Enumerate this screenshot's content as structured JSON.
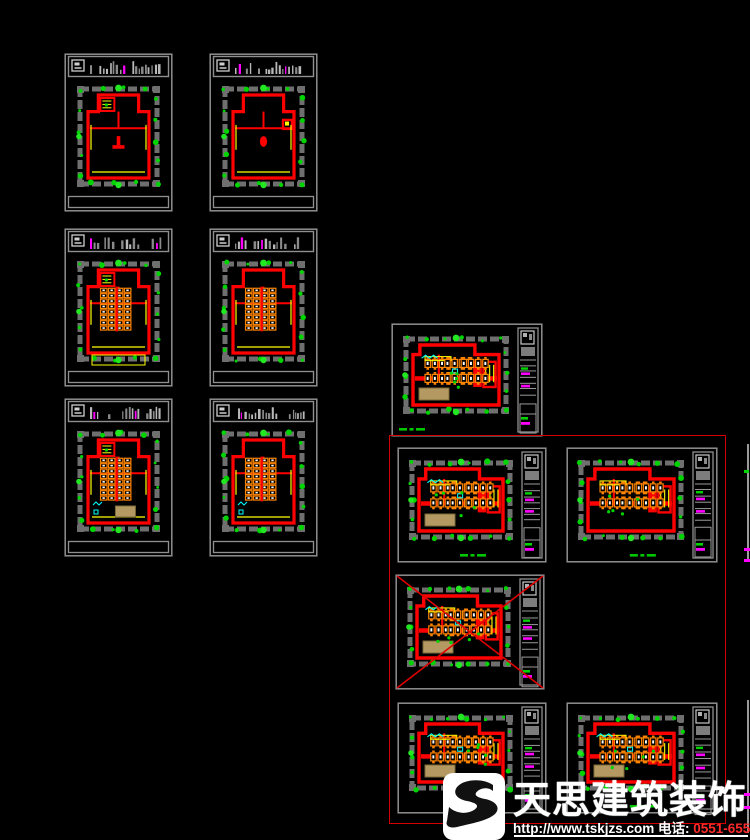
{
  "app": {
    "background": "#000000",
    "canvas_name": "cad-model-space"
  },
  "palette": {
    "frame": "#8f8f8f",
    "strip_bars": "#a8a8a8",
    "band": "#6f6f6f",
    "wall_red": "#ff0000",
    "green": "#00d400",
    "green_bright": "#22e822",
    "yellow": "#ffff00",
    "orange": "#ff8400",
    "cyan": "#00ffff",
    "magenta": "#ff00ff",
    "tan": "#b49a62",
    "tan_edge": "#7d6a38",
    "selection_red": "#d40000",
    "cross_red": "#e00000",
    "caption_green": "#00c800",
    "logo_white": "#ffffff",
    "phone_red": "#ff2a2a"
  },
  "logo": {
    "brand_text": "天思建筑装饰",
    "url_text": "http://www.tskjzs.com",
    "phone_label": " 电话: ",
    "phone_number": "0551-65568226",
    "icon": "tiansi-s-swirl"
  },
  "selection_box": {
    "x": 389,
    "y": 435,
    "w": 335,
    "h": 387
  },
  "drawings": [
    {
      "id": "plan-1f-a",
      "x": 64,
      "y": 53,
      "w": 109,
      "h": 159,
      "orient": "portrait",
      "seed": 11,
      "furniture": false,
      "topRoom": true,
      "blob": "tee",
      "yellowRect": false,
      "cyan": false,
      "tan": false,
      "crossed": false,
      "caption": ""
    },
    {
      "id": "plan-1f-b",
      "x": 209,
      "y": 53,
      "w": 109,
      "h": 159,
      "orient": "portrait",
      "seed": 22,
      "furniture": false,
      "topRoom": false,
      "blob": "oval",
      "yellowRect": false,
      "cyan": false,
      "tan": false,
      "crossed": false,
      "caption": ""
    },
    {
      "id": "plan-2f-a",
      "x": 64,
      "y": 228,
      "w": 109,
      "h": 159,
      "orient": "portrait",
      "seed": 33,
      "furniture": true,
      "topRoom": true,
      "blob": "tee",
      "yellowRect": true,
      "cyan": false,
      "tan": false,
      "crossed": false,
      "caption": ""
    },
    {
      "id": "plan-2f-b",
      "x": 209,
      "y": 228,
      "w": 109,
      "h": 159,
      "orient": "portrait",
      "seed": 44,
      "furniture": true,
      "topRoom": false,
      "blob": "none",
      "yellowRect": false,
      "cyan": false,
      "tan": false,
      "crossed": false,
      "caption": ""
    },
    {
      "id": "plan-3f-a",
      "x": 64,
      "y": 398,
      "w": 109,
      "h": 159,
      "orient": "portrait",
      "seed": 55,
      "furniture": true,
      "topRoom": true,
      "blob": "none",
      "yellowRect": false,
      "cyan": true,
      "tan": true,
      "crossed": false,
      "caption": ""
    },
    {
      "id": "plan-3f-b",
      "x": 209,
      "y": 398,
      "w": 109,
      "h": 159,
      "orient": "portrait",
      "seed": 66,
      "furniture": true,
      "topRoom": false,
      "blob": "none",
      "yellowRect": false,
      "cyan": true,
      "tan": false,
      "crossed": false,
      "caption": ""
    },
    {
      "id": "layout-a",
      "x": 391,
      "y": 323,
      "w": 152,
      "h": 114,
      "orient": "landscape",
      "seed": 77,
      "furniture": true,
      "topRoom": false,
      "blob": "none",
      "yellowRect": false,
      "cyan": true,
      "tan": true,
      "crossed": false,
      "caption": "left"
    },
    {
      "id": "layout-b",
      "x": 397,
      "y": 447,
      "w": 150,
      "h": 116,
      "orient": "landscape",
      "seed": 88,
      "furniture": true,
      "topRoom": false,
      "blob": "none",
      "yellowRect": false,
      "cyan": true,
      "tan": true,
      "crossed": false,
      "caption": "center"
    },
    {
      "id": "layout-c",
      "x": 566,
      "y": 447,
      "w": 152,
      "h": 116,
      "orient": "landscape",
      "seed": 99,
      "furniture": true,
      "topRoom": false,
      "blob": "none",
      "yellowRect": false,
      "cyan": false,
      "tan": false,
      "crossed": false,
      "caption": "center"
    },
    {
      "id": "layout-d-voided",
      "x": 395,
      "y": 574,
      "w": 150,
      "h": 116,
      "orient": "landscape",
      "seed": 111,
      "furniture": true,
      "topRoom": false,
      "blob": "none",
      "yellowRect": false,
      "cyan": true,
      "tan": true,
      "crossed": true,
      "caption": ""
    },
    {
      "id": "layout-e",
      "x": 397,
      "y": 702,
      "w": 150,
      "h": 112,
      "orient": "landscape",
      "seed": 122,
      "furniture": true,
      "topRoom": false,
      "blob": "none",
      "yellowRect": false,
      "cyan": true,
      "tan": true,
      "crossed": false,
      "caption": "center"
    },
    {
      "id": "layout-f",
      "x": 566,
      "y": 702,
      "w": 152,
      "h": 112,
      "orient": "landscape",
      "seed": 133,
      "furniture": true,
      "topRoom": false,
      "blob": "none",
      "yellowRect": false,
      "cyan": true,
      "tan": true,
      "crossed": false,
      "caption": "center"
    }
  ],
  "edge_fragments": [
    {
      "x": 747,
      "y": 444,
      "w": 2,
      "h": 118
    },
    {
      "x": 747,
      "y": 700,
      "w": 2,
      "h": 133
    }
  ],
  "edge_fragment_bits": [
    {
      "x": 744,
      "y": 470,
      "w": 5,
      "h": 3,
      "color": "#00d400"
    },
    {
      "x": 744,
      "y": 548,
      "w": 6,
      "h": 3,
      "color": "#ff00ff"
    },
    {
      "x": 744,
      "y": 559,
      "w": 6,
      "h": 3,
      "color": "#ff00ff"
    },
    {
      "x": 744,
      "y": 793,
      "w": 6,
      "h": 3,
      "color": "#ff00ff"
    },
    {
      "x": 744,
      "y": 806,
      "w": 6,
      "h": 3,
      "color": "#ff00ff"
    }
  ]
}
